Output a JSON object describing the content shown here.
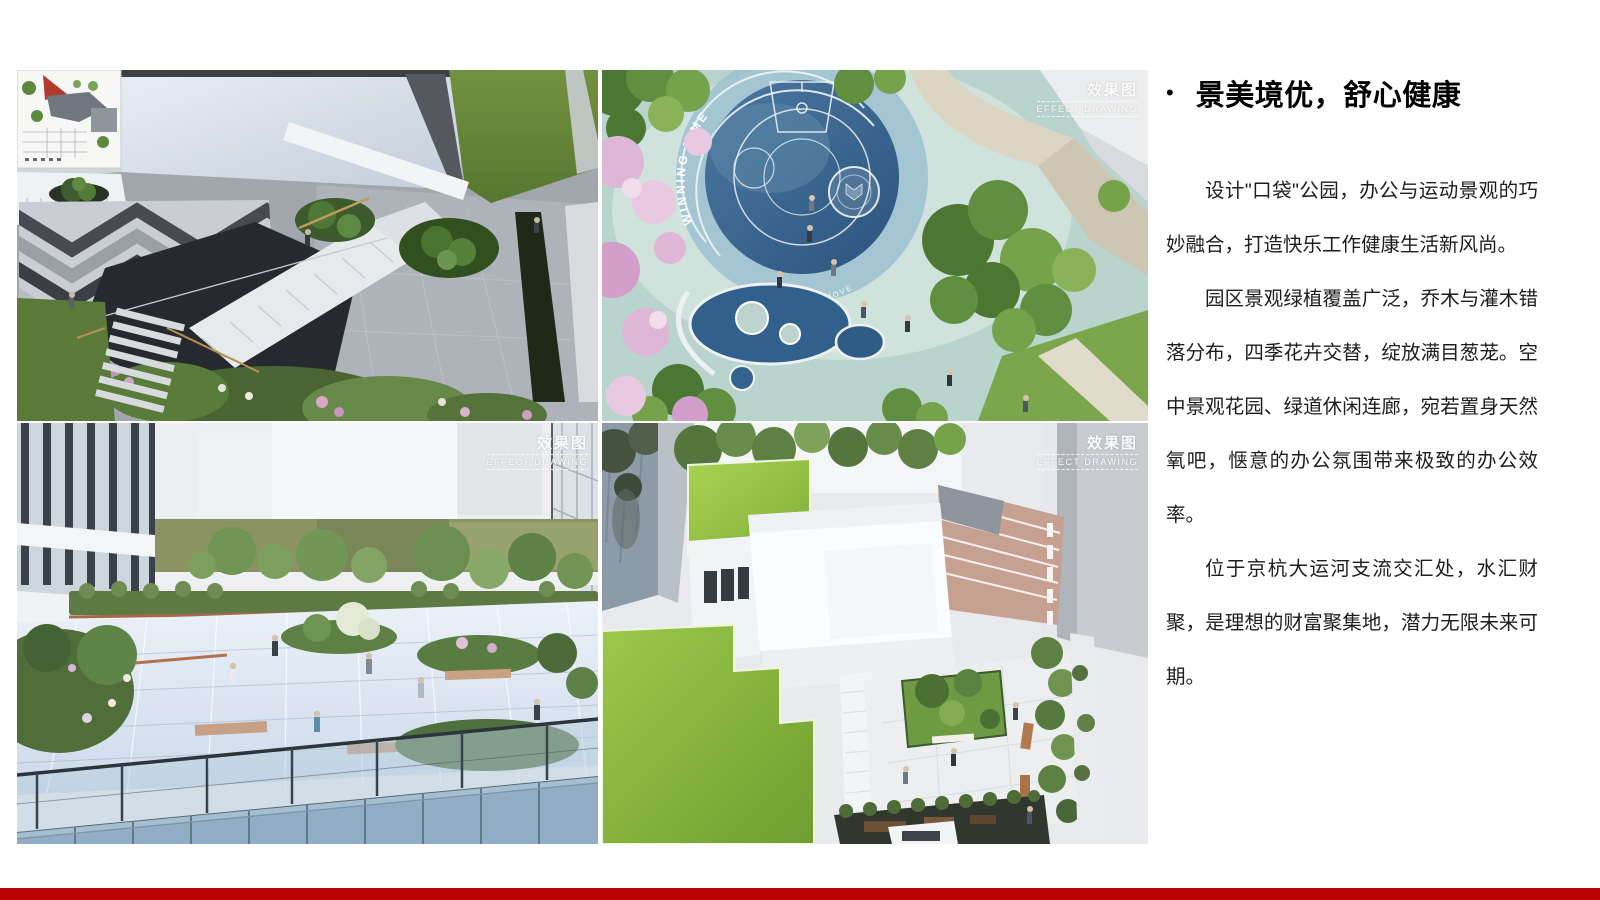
{
  "slide": {
    "background_color": "#ffffff",
    "accent_bar_color": "#b80303"
  },
  "content": {
    "bullet_glyph": "•",
    "title": "景美境优，舒心健康",
    "paragraphs": [
      "设计\"口袋\"公园，办公与运动景观的巧妙融合，打造快乐工作健康生活新风尚。",
      "园区景观绿植覆盖广泛，乔木与灌木错落分布，四季花卉交替，绽放满目葱茏。空中景观花园、绿道休闲连廊，宛若置身天然氧吧，惬意的办公氛围带来极致的办公效率。",
      "位于京杭大运河支流交汇处，水汇财聚，是理想的财富聚集地，潜力无限未来可期。"
    ]
  },
  "gallery": {
    "watermark": {
      "cn": "效果图",
      "en": "EFFECT DRAWING"
    },
    "images": [
      {
        "name": "courtyard-garden-aerial-render"
      },
      {
        "name": "pocket-park-basketball-court-aerial-render",
        "court_text_arc": "WINNING TIME",
        "court_text_small": "LIFE LIES IN MOVE"
      },
      {
        "name": "roof-terrace-garden-render"
      },
      {
        "name": "rooftop-courtyard-aerial-render"
      }
    ]
  }
}
